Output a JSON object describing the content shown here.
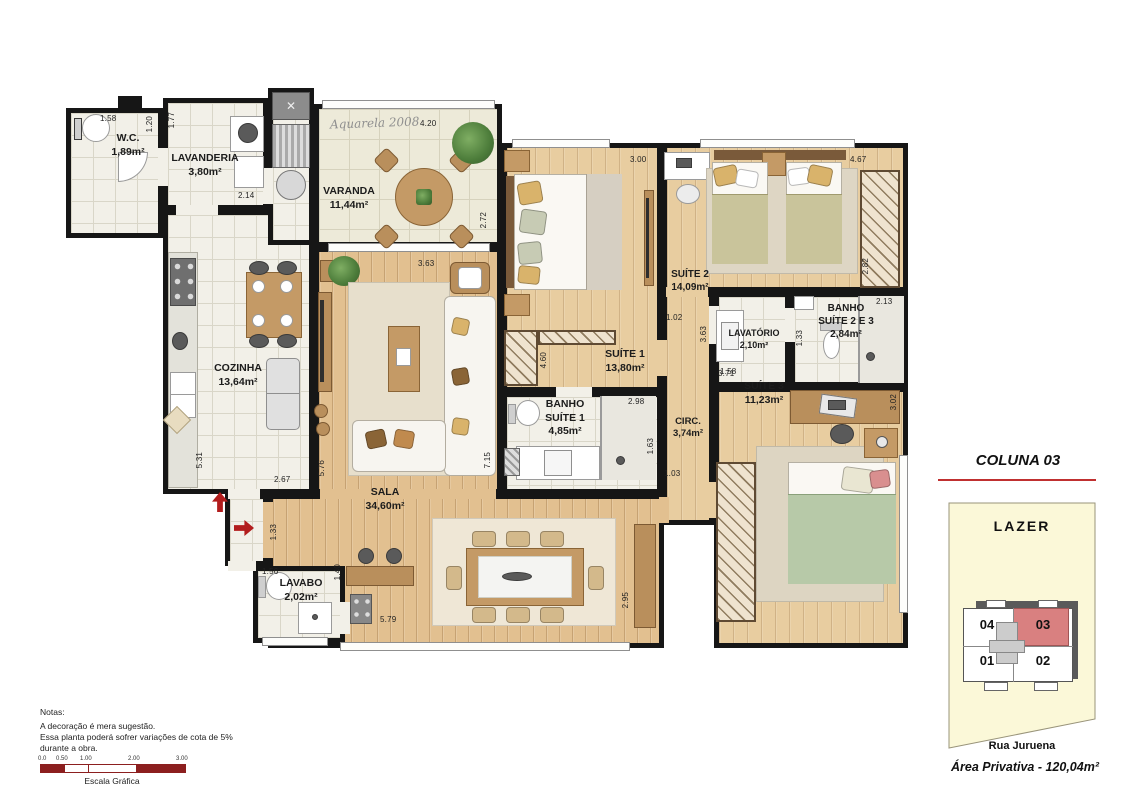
{
  "plan": {
    "signature": "Aquarela 2008",
    "rooms": {
      "wc": {
        "name": "W.C.",
        "area": "1,89m²"
      },
      "lavanderia": {
        "name": "LAVANDERIA",
        "area": "3,80m²"
      },
      "varanda": {
        "name": "VARANDA",
        "area": "11,44m²"
      },
      "cozinha": {
        "name": "COZINHA",
        "area": "13,64m²"
      },
      "sala": {
        "name": "SALA",
        "area": "34,60m²"
      },
      "lavabo": {
        "name": "LAVABO",
        "area": "2,02m²"
      },
      "suite1": {
        "name": "SUÍTE 1",
        "area": "13,80m²"
      },
      "banho1": {
        "name": "BANHO\nSUÍTE 1",
        "area": "4,85m²"
      },
      "circ": {
        "name": "CIRC.",
        "area": "3,74m²"
      },
      "suite2": {
        "name": "SUÍTE 2",
        "area": "14,09m²"
      },
      "lavatorio": {
        "name": "LAVATÓRIO",
        "area": "2,10m²"
      },
      "banho23": {
        "name": "BANHO\nSUÍTE 2 E 3",
        "area": "2,84m²"
      },
      "suite3": {
        "name": "SUÍTE 3",
        "area": "11,23m²"
      }
    },
    "dims": {
      "wc_w": "1.58",
      "wc_h": "1.20",
      "lvd_h": "1.77",
      "lvd_w": "2.14",
      "var_w": "4.20",
      "var_h": "2.72",
      "coz_h": "5.31",
      "coz_w": "2.67",
      "sala_l": "5.76",
      "sala_w": "3.63",
      "sala_r": "7.15",
      "sala_b": "5.79",
      "hall_h": "1.33",
      "lvb_w": "1.56",
      "lvb_h": "1.40",
      "s1_w": "3.00",
      "s1_h": "4.60",
      "b1_w": "2.98",
      "b1_h": "1.63",
      "circ_w": "1.03",
      "circ_d": "1.02",
      "s2_w": "4.67",
      "s2_h": "2.82",
      "lvt_h": "3.63",
      "lvt_w": "1.58",
      "b23_w": "2.13",
      "b23_h": "1.33",
      "s3_t": "3.71",
      "s3_h": "3.02",
      "din_h": "2.95"
    }
  },
  "keyplan": {
    "title": "COLUNA 03",
    "lazer": "LAZER",
    "units": {
      "u01": "01",
      "u02": "02",
      "u03": "03",
      "u04": "04"
    },
    "street": "Rua Juruena",
    "private_area": "Área Privativa  - 120,04m²",
    "highlight_color": "#d98080"
  },
  "notes": {
    "heading": "Notas:",
    "lines": [
      "A decoração é mera sugestão.",
      "Essa planta poderá sofrer variações de cota de 5%",
      "durante a obra."
    ]
  },
  "scale": {
    "ticks": [
      "0.0",
      "0.50",
      "1.00",
      "2.00",
      "3.00"
    ],
    "caption": "Escala Gráfica"
  }
}
